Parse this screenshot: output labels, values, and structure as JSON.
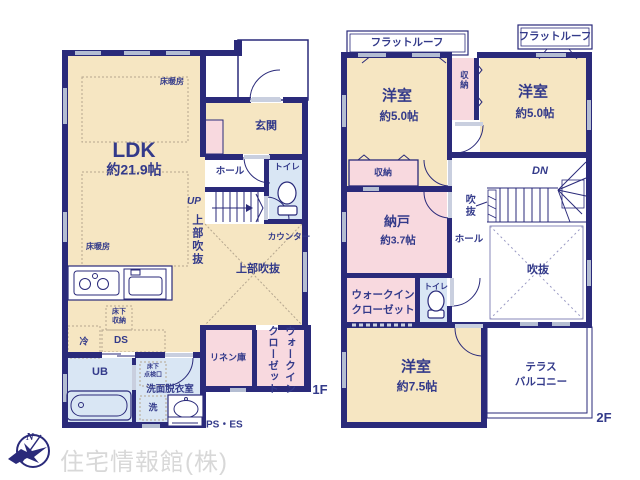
{
  "colors": {
    "wall": "#2a2a7a",
    "text": "#333a8a",
    "cream": "#f6e6c2",
    "pink": "#f8d9df",
    "blue": "#d9e6f4",
    "window_gray": "#b4bdd2",
    "dash_tan": "#b5a68f",
    "watermark": "#d8d8d8"
  },
  "floor1": {
    "label": "1F",
    "rooms": {
      "ldk_name": "LDK",
      "ldk_size": "約21.9帖",
      "entrance": "玄関",
      "hall": "ホール",
      "toilet": "トイレ",
      "ub": "UB",
      "washroom": "洗面脱衣室",
      "linen": "リネン庫",
      "wic": "ウォークイン\nクローゼット",
      "void_upper": "上部吹抜",
      "void_upper_side": "上部吹抜"
    },
    "annotations": {
      "floor_heating_a": "床暖房",
      "floor_heating_b": "床暖房",
      "up": "UP",
      "counter": "カウンター",
      "underfloor_storage": "床下\n収納",
      "fridge": "冷",
      "duct": "DS",
      "hatch": "床下\n点検口",
      "washer": "洗",
      "ps_es": "PS・ES"
    }
  },
  "floor2": {
    "label": "2F",
    "rooms": {
      "bedroom_left_name": "洋室",
      "bedroom_left_size": "約5.0帖",
      "bedroom_right_name": "洋室",
      "bedroom_right_size": "約5.0帖",
      "bedroom_main_name": "洋室",
      "bedroom_main_size": "約7.5帖",
      "storage_room_name": "納戸",
      "storage_room_size": "約3.7帖",
      "closet_strip": "収納",
      "closet_left": "収納",
      "hall": "ホール",
      "toilet": "トイレ",
      "wic": "ウォークイン\nクローゼット",
      "void": "吹抜",
      "void_side": "吹抜",
      "terrace": "テラス\nバルコニー"
    },
    "annotations": {
      "flat_roof_left": "フラットルーフ",
      "flat_roof_right": "フラットルーフ",
      "dn": "DN"
    }
  },
  "compass": {
    "north": "N"
  },
  "watermark": "住宅情報館(株)"
}
